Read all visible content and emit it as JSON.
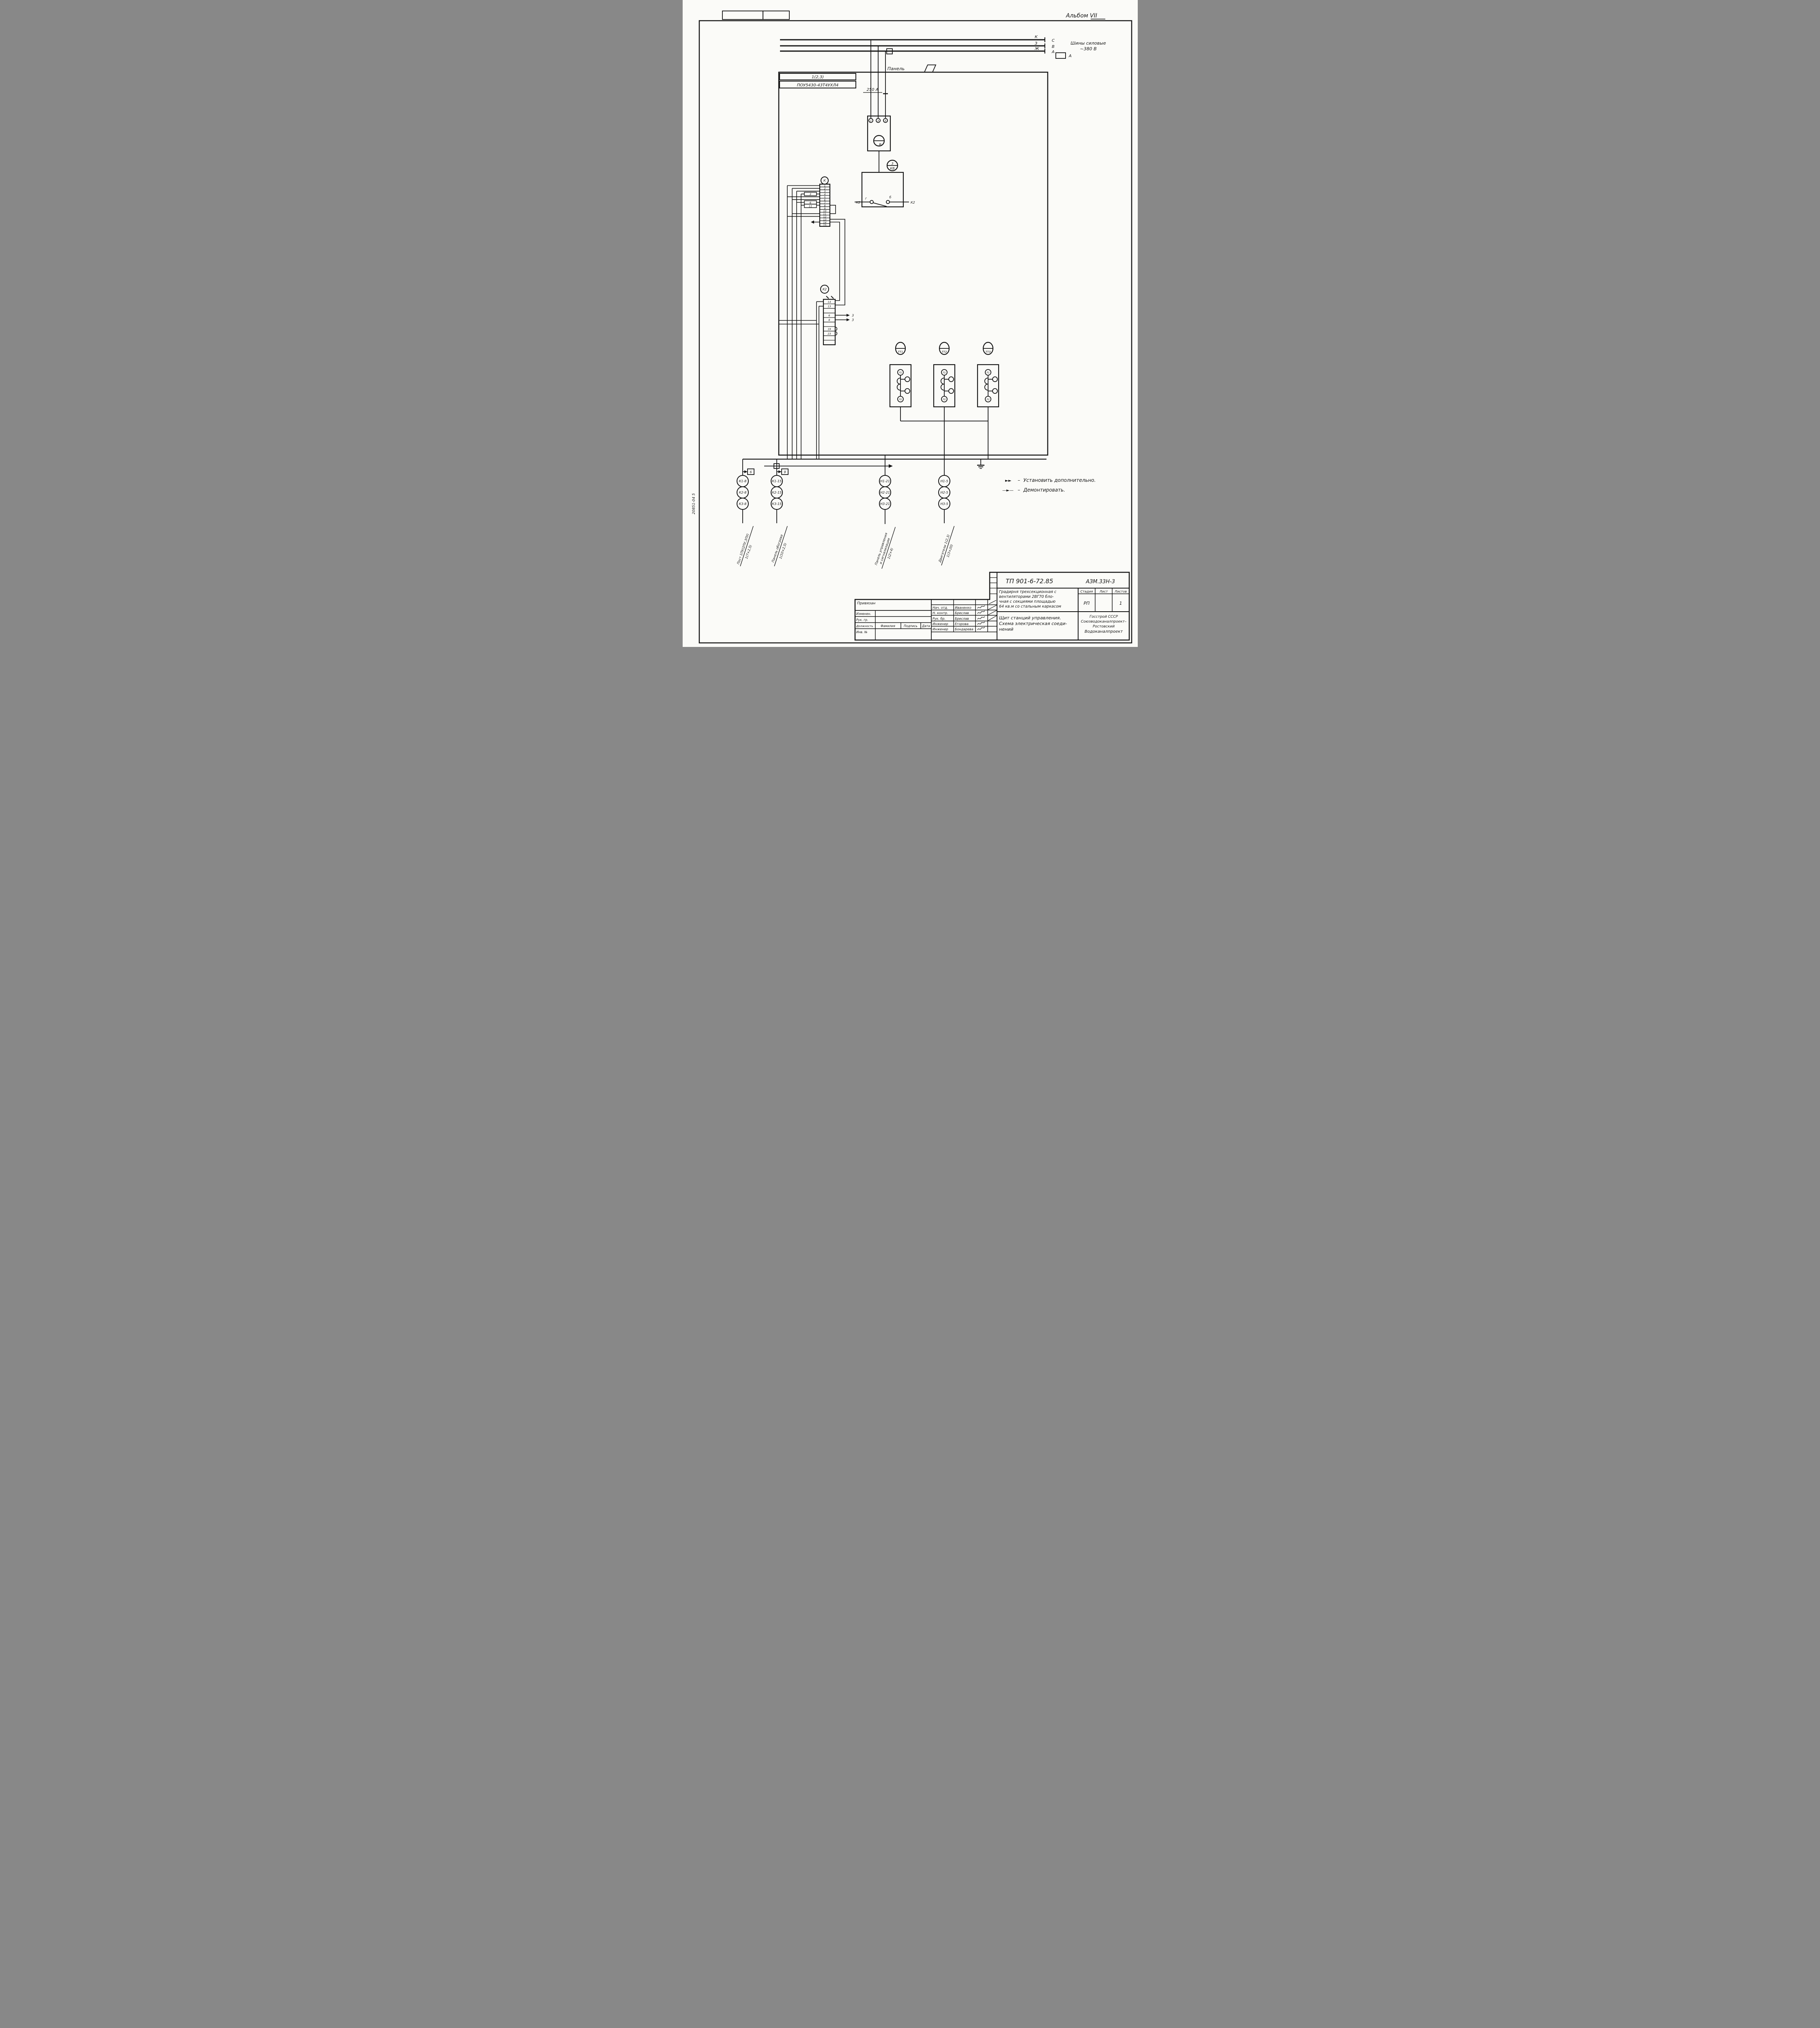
{
  "album": "Альбом VII",
  "margin_code": "20851-04      5",
  "bus": {
    "label_line1": "Шины силовые",
    "label_line2": "~380 В",
    "phases": [
      "К",
      "З",
      "Ж"
    ],
    "ends": [
      "С",
      "В",
      "А"
    ],
    "box_label": "А"
  },
  "panel": {
    "title": "Панель",
    "ref": "1(2,3)",
    "type": "ПОУ5430-43Т4УХЛ4",
    "fuse": "250 А"
  },
  "breaker": {
    "t1": "1",
    "t2": "3",
    "t3": "5",
    "meter": "В"
  },
  "kv": {
    "num": "3",
    "name": "КВ",
    "left": "К2",
    "right": "К2",
    "c1": "г",
    "c2": "б"
  },
  "k": {
    "title": "К",
    "cells": [
      "1",
      "2",
      "3",
      "4",
      "5",
      "6",
      "7",
      "8",
      "9",
      "10",
      "11",
      "12",
      "13",
      "14",
      "15"
    ],
    "tags": [
      "3",
      "6",
      "11"
    ]
  },
  "k2": {
    "title": "К2",
    "cells": [
      "14",
      "13",
      "",
      "6",
      "8",
      "",
      "19",
      "23",
      "",
      ""
    ],
    "wire1": "3",
    "wire2": "3"
  },
  "tt": {
    "items": [
      "ТТ1",
      "ТТ2",
      "ТТ3"
    ],
    "l1": "Л1",
    "l2": "Л2"
  },
  "cols": {
    "tagA": "6",
    "tagB": "9",
    "a": [
      "К1-8",
      "К2-8",
      "К3-8"
    ],
    "b": [
      "К1-15",
      "К2-15",
      "К3-15"
    ],
    "c": [
      "Н1-21",
      "Н2-21",
      "Н3-21"
    ],
    "d": [
      "Н1-5",
      "Н2-5",
      "Н3-5"
    ],
    "la1": "Пост 1ПУ(2ПУ,3ПУ)",
    "la2": "1(7×2,5)",
    "lb1": "Панель обогрева",
    "lb2": "1(10×2,5)",
    "lc1": "Панель управления",
    "lc1b": "и сигнализации",
    "lc2": "1(2×4)",
    "ld1": "Двигатели 1(2,3)",
    "ld2": "1(3×20)"
  },
  "notes": {
    "s1": "►►",
    "d1": "–",
    "t1": "Установить дополнительно.",
    "s2": "—►—",
    "d2": "–",
    "t2": "Демонтировать."
  },
  "tb": {
    "doc": "ТП 901-6-72.85",
    "code": "АЗМ.33Н-3",
    "p1": "Градирня трехсекционная с",
    "p2": "вентиляторами 2ВГ70 бло-",
    "p3": "чная с секциями площадью",
    "p4": "64 кв.м со стальным каркасом",
    "h_stage": "Стадия",
    "h_sheet": "Лист",
    "h_sheets": "Листов",
    "stage": "РП",
    "sheet": "",
    "sheets": "1",
    "t1": "Щит станций управления.",
    "t2": "Схема электрическая соеди-",
    "t3": "нений",
    "o1": "Госстрой СССР",
    "o2": "Союзводоканалпроект–",
    "o3": "Ростовский",
    "o4": "Водоканалпроект",
    "annot": "Привязан",
    "r1": "Изменен.",
    "r2": "Рук. гр.",
    "r3": "Инв. №",
    "hdr": [
      "Должность",
      "Фамилия",
      "Подпись",
      "Дата"
    ],
    "signers": [
      {
        "role": "Нач. отд.",
        "name": "Иваненко"
      },
      {
        "role": "Н. контр.",
        "name": "Бреслав"
      },
      {
        "role": "Рук. бр.",
        "name": "Бреслав"
      },
      {
        "role": "Инженер",
        "name": "Егорова"
      },
      {
        "role": "Инженер",
        "name": "Бондарева"
      }
    ]
  }
}
